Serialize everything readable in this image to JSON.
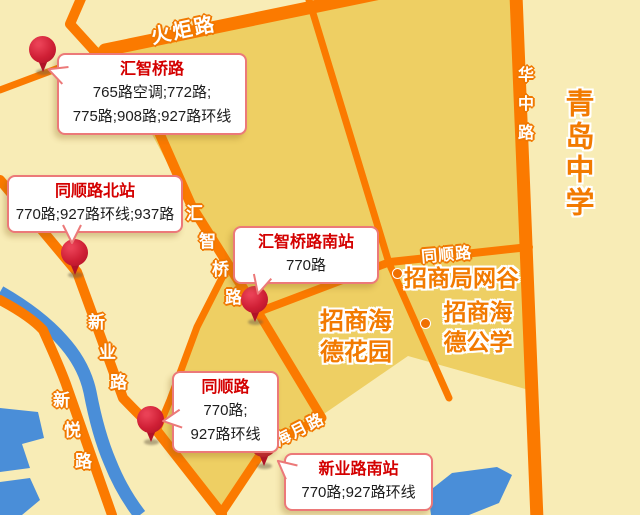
{
  "map_name": "bus stops map",
  "colors": {
    "bg_light": "#f8ecb6",
    "bg_dark": "#eecf63",
    "road": "#fb7a00",
    "water": "#4a8ed8",
    "poi_text": "#f27a00",
    "road_label_text": "#ffffff",
    "stop_title": "#d40000",
    "callout_border": "#ec7979",
    "pin_red": "#cf1f35"
  },
  "road_labels": {
    "huoju": "火炬路",
    "huazhong": "华中路",
    "tongshun": "同顺路",
    "haiyue": "海月路",
    "huizhiqiao_chars": [
      "汇",
      "智",
      "桥",
      "路"
    ],
    "xinye_chars": [
      "新",
      "业",
      "路"
    ],
    "xinyue_chars": [
      "新",
      "悦",
      "路"
    ]
  },
  "pois": {
    "qingdao_school": "青岛中学",
    "wanggu": "招商局网谷",
    "haide_garden": [
      "招商海",
      "德花园"
    ],
    "haide_school": [
      "招商海",
      "德公学"
    ]
  },
  "stops": [
    {
      "name": "汇智桥路",
      "lines": [
        "765路空调;772路;",
        "775路;908路;927路环线"
      ]
    },
    {
      "name": "同顺路北站",
      "lines": [
        "770路;927路环线;937路"
      ]
    },
    {
      "name": "汇智桥路南站",
      "lines": [
        "770路"
      ]
    },
    {
      "name": "同顺路",
      "lines": [
        "770路;",
        "927路环线"
      ]
    },
    {
      "name": "新业路南站",
      "lines": [
        "770路;927路环线"
      ]
    }
  ]
}
